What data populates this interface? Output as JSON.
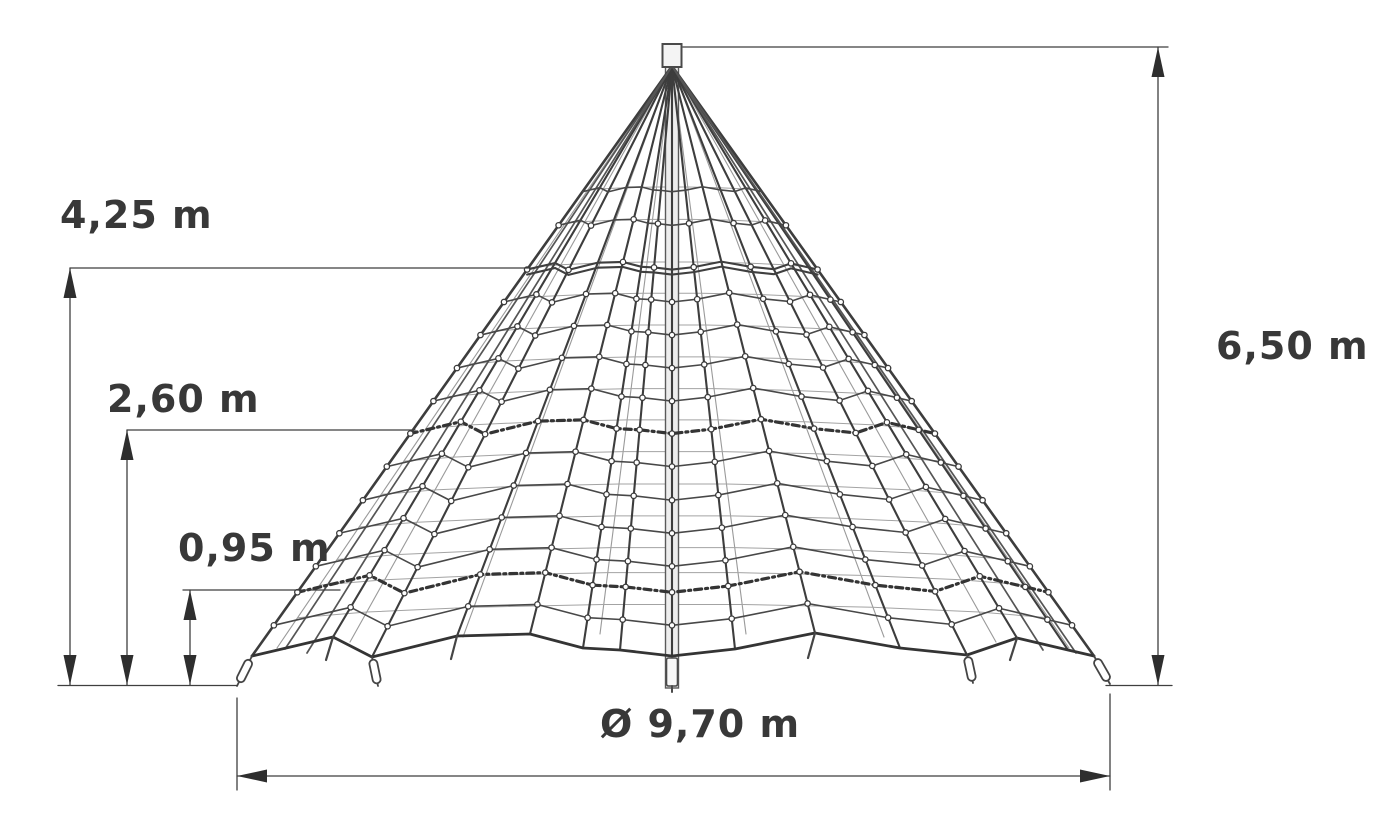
{
  "diagram": {
    "dimensions": {
      "level1_height": {
        "label": "4,25 m",
        "value": 4.25,
        "unit": "m"
      },
      "level2_height": {
        "label": "2,60 m",
        "value": 2.6,
        "unit": "m"
      },
      "level3_height": {
        "label": "0,95 m",
        "value": 0.95,
        "unit": "m"
      },
      "total_height": {
        "label": "6,50 m",
        "value": 6.5,
        "unit": "m"
      },
      "base_diameter": {
        "label": "Ø 9,70 m",
        "value": 9.7,
        "unit": "m"
      }
    }
  }
}
